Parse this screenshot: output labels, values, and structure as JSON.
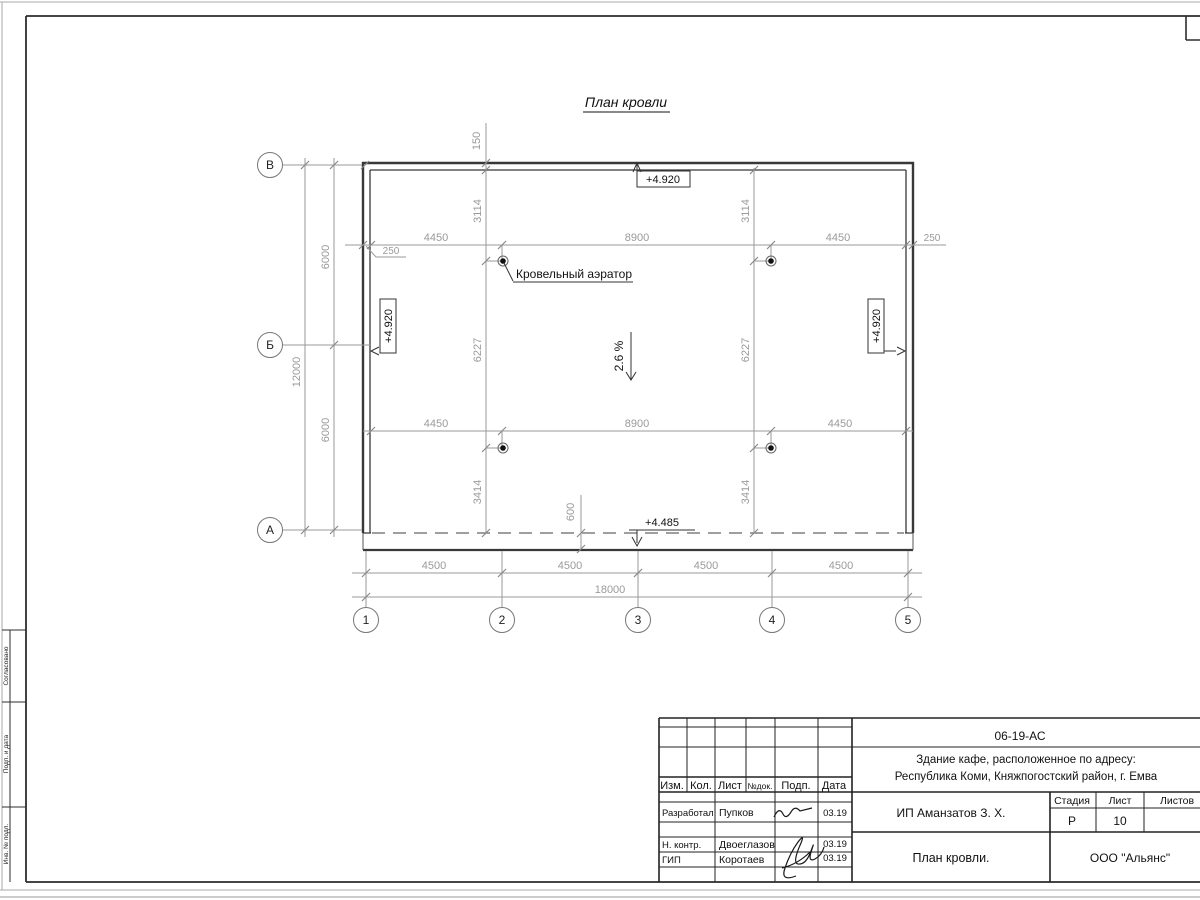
{
  "sheet": {
    "title": "План кровли"
  },
  "plan": {
    "axis_rows": [
      "В",
      "Б",
      "А"
    ],
    "axis_cols": [
      "1",
      "2",
      "3",
      "4",
      "5"
    ]
  },
  "dims": {
    "top": [
      "4450",
      "8900",
      "4450"
    ],
    "offset_left": "250",
    "offset_right": "250",
    "mid": [
      "4450",
      "8900",
      "4450"
    ],
    "cols": [
      "4500",
      "4500",
      "4500",
      "4500"
    ],
    "total_w": "18000",
    "rows": [
      "6000",
      "6000"
    ],
    "total_h": "12000",
    "chain_left": [
      "3114",
      "6227",
      "3414"
    ],
    "chain_right": [
      "3114",
      "6227",
      "3414"
    ],
    "parapet": "150",
    "overhang": "600"
  },
  "marks": {
    "elev_top": "+4.920",
    "elev_left": "+4.920",
    "elev_right": "+4.920",
    "elev_low": "+4.485",
    "slope": "2.6 %",
    "aerator": "Кровельный аэратор"
  },
  "tb": {
    "doc": "06-19-АС",
    "obj1": "Здание кафе, расположенное по адресу:",
    "obj2": "Республика Коми, Княжпогостский район, г. Емва",
    "h": {
      "izm": "Изм.",
      "kol": "Кол.",
      "list": "Лист",
      "ndoc": "№док.",
      "podp": "Подп.",
      "data": "Дата"
    },
    "rows": [
      {
        "role": "Разработал",
        "name": "Пупков",
        "date": "03.19"
      },
      {
        "role": "Н. контр.",
        "name": "Двоеглазов",
        "date": "03.19"
      },
      {
        "role": "ГИП",
        "name": "Коротаев",
        "date": "03.19"
      }
    ],
    "client": "ИП Аманзатов З. Х.",
    "stage": {
      "h0": "Стадия",
      "h1": "Лист",
      "h2": "Листов",
      "v0": "Р",
      "v1": "10",
      "v2": ""
    },
    "sheet_title": "План кровли.",
    "company": "ООО \"Альянс\""
  },
  "margin": [
    "Согласовано",
    "Подп. и дата",
    "Инв. № подл."
  ]
}
